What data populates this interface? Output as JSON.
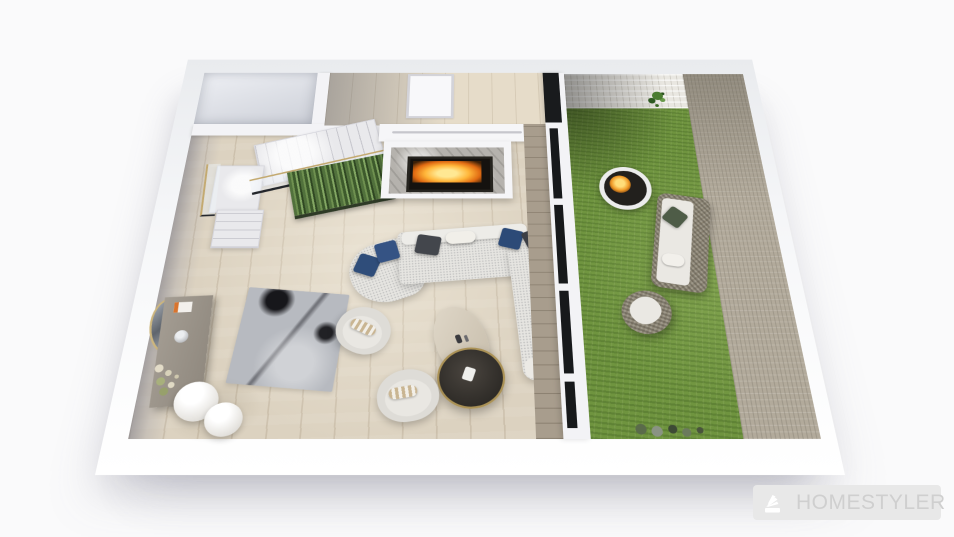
{
  "app": {
    "name": "Homestyler 3D floorplan render",
    "watermark": "HOMESTYLER"
  },
  "scene": {
    "type": "isometric-3d-floorplan-render",
    "rooms": [
      {
        "name": "living-room",
        "floor": "light-oak-plank"
      },
      {
        "name": "back-hallway",
        "features": [
          "white-interior-door"
        ]
      },
      {
        "name": "storage-room-top-left"
      },
      {
        "name": "garden-patio",
        "floor": "grass",
        "walls": "brick"
      }
    ],
    "objects": [
      "marble-staircase-with-gold-and-glass-railing",
      "under-stair-plant-wall",
      "fireplace-with-marble-surround-and-burning-fire",
      "white-mantel-ledge",
      "l-shaped-sectional-sofa",
      "navy-and-charcoal-throw-pillows",
      "oval-cream-coffee-table",
      "round-dark-coffee-table-with-gold-rim",
      "fabric-armchair-with-bolster",
      "fabric-armchair-with-bolster",
      "gray-abstract-area-rug",
      "console-table-with-decor",
      "oval-wall-mirror",
      "vase-with-flowers",
      "double-globe-floor-lamp",
      "black-framed-glass-partition",
      "grass-lawn",
      "round-fire-pit",
      "outdoor-wicker-sofa",
      "outdoor-wicker-armchair",
      "wall-hanging-plant",
      "garden-border-shrubs"
    ],
    "palette": {
      "bg": "#fafafb",
      "wall": "#f3f3f6",
      "wood": "#dcd2c0",
      "grass": "#6f943f",
      "brick-beige": "#b2aa9b",
      "brick-white": "#e9e7e1",
      "sofa": "#e6e5e1",
      "pillow-navy": "#2f4d7a",
      "pillow-charcoal": "#43464c",
      "marble": "#b5b2ad",
      "fire-orange": "#f09a28",
      "fire-yellow": "#ffdd7a",
      "gold": "#c3a96f",
      "glass-dark": "#17191b",
      "rug": "#b7bac0",
      "wicker": "#8f8878",
      "cushion-white": "#eae8e3",
      "table-dark": "#2e2b27",
      "watermark-bg": "#e8e8e8",
      "watermark-text": "#cfcfcf"
    }
  }
}
